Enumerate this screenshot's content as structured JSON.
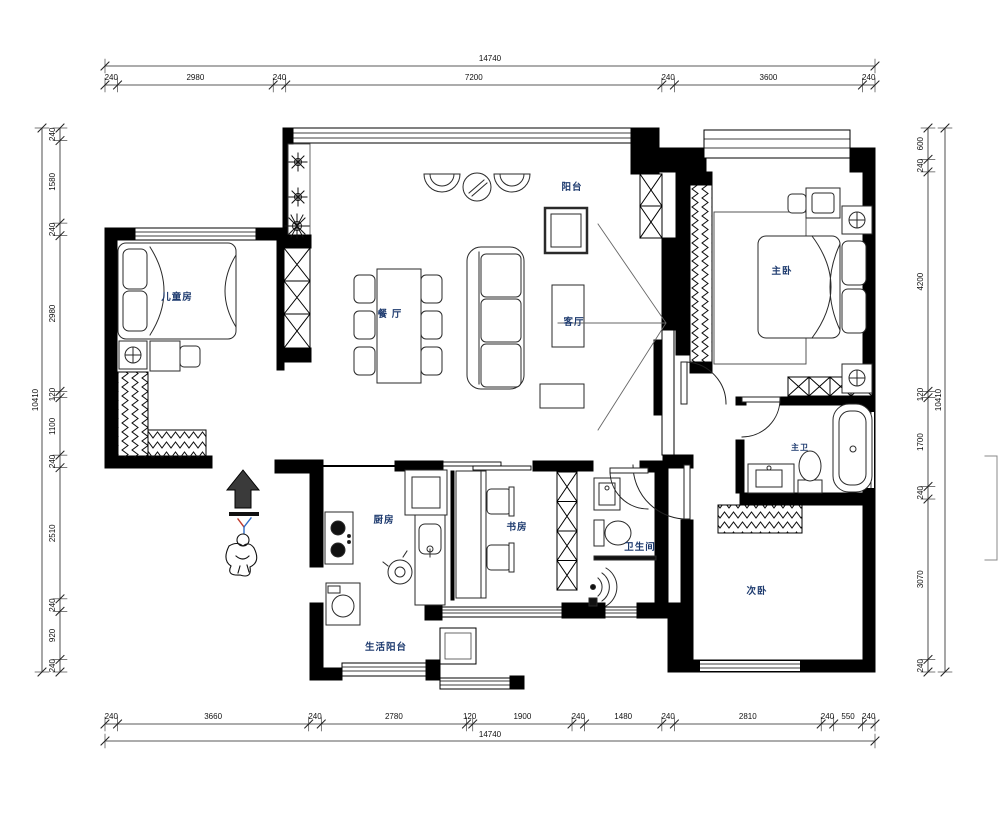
{
  "plan_title": "three-bedroom apartment floor plan",
  "colors": {
    "wall": "#000000",
    "furniture_line": "#2a2a2a",
    "dimension_line": "#222222",
    "room_label": "#1d3a6e",
    "background": "#ffffff"
  },
  "rooms": {
    "balcony": "阳台",
    "dining": "餐 厅",
    "living": "客厅",
    "master_bedroom": "主卧",
    "kids_room": "儿童房",
    "kitchen": "厨房",
    "study": "书房",
    "bathroom": "卫生间",
    "master_bath": "主卫",
    "second_bedroom": "次卧",
    "utility_balcony": "生活阳台"
  },
  "dimensions": {
    "top": {
      "total": 14740,
      "segments": [
        240,
        2980,
        240,
        7200,
        240,
        3600,
        240
      ]
    },
    "bottom": {
      "total": 14740,
      "segments": [
        240,
        3660,
        240,
        2780,
        120,
        1900,
        240,
        1480,
        240,
        2810,
        240,
        550,
        240
      ]
    },
    "left": {
      "total": 10410,
      "segments": [
        240,
        1580,
        240,
        2980,
        120,
        1100,
        240,
        2510,
        240,
        920,
        240
      ]
    },
    "right": {
      "total": 10410,
      "segments": [
        600,
        240,
        4200,
        120,
        1700,
        240,
        3070,
        240
      ]
    }
  }
}
